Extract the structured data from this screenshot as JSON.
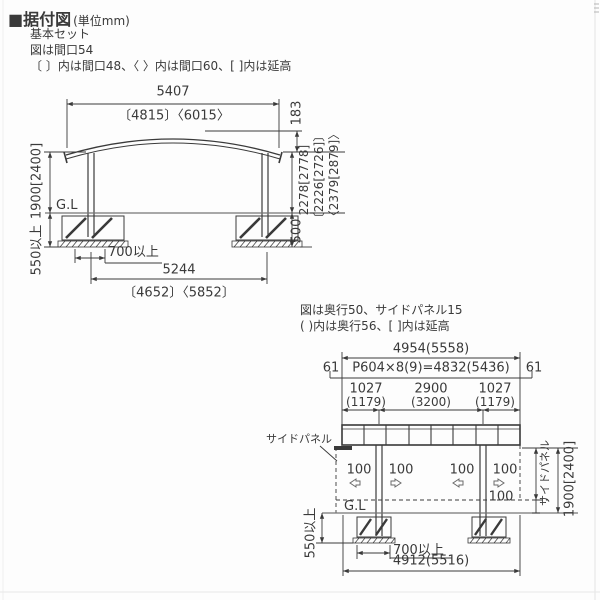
{
  "header": {
    "title": "■据付図",
    "unit": "(単位mm)",
    "note1": "基本セット",
    "note2": "図は間口54",
    "note3": "〔 〕内は間口48、〈 〉内は間口60、[ ]内は延高"
  },
  "elevation": {
    "width": "5407",
    "width_alt": "〔4815〕〈6015〉",
    "rise": "183",
    "height1": "2278[2778]",
    "height2": "〔2226[2726]〕",
    "height3": "〈2379[2879]〉",
    "embed_right": "500",
    "post_height": "1900[2400]",
    "embed_left": "550以上",
    "footing_width": "700以上",
    "span": "5244",
    "span_alt": "〔4652〕〈5852〕",
    "gl": "G.L"
  },
  "side_view": {
    "note1": "図は奥行50、サイドパネル15",
    "note2": "( )内は奥行56、[ ]内は延高",
    "overall_width": "4954(5558)",
    "panel_formula": "P604×8(9)=4832(5436)",
    "edge_left": "61",
    "edge_right": "61",
    "seg1": "1027",
    "seg1_alt": "(1179)",
    "seg2": "2900",
    "seg2_alt": "(3200)",
    "seg3": "1027",
    "seg3_alt": "(1179)",
    "off1": "100",
    "off2": "100",
    "off3": "100",
    "off4": "100",
    "gap": "100",
    "panel_label": "サイドパネル",
    "panel_dim_label": "サイドパネル",
    "post_height": "1900[2400]",
    "embed": "550以上",
    "footing_width": "700以上",
    "base_width": "4912(5516)",
    "gl": "G.L"
  },
  "colors": {
    "line": "#3a3a3a",
    "ground_line": "#767676",
    "background": "#fdfdfd"
  }
}
